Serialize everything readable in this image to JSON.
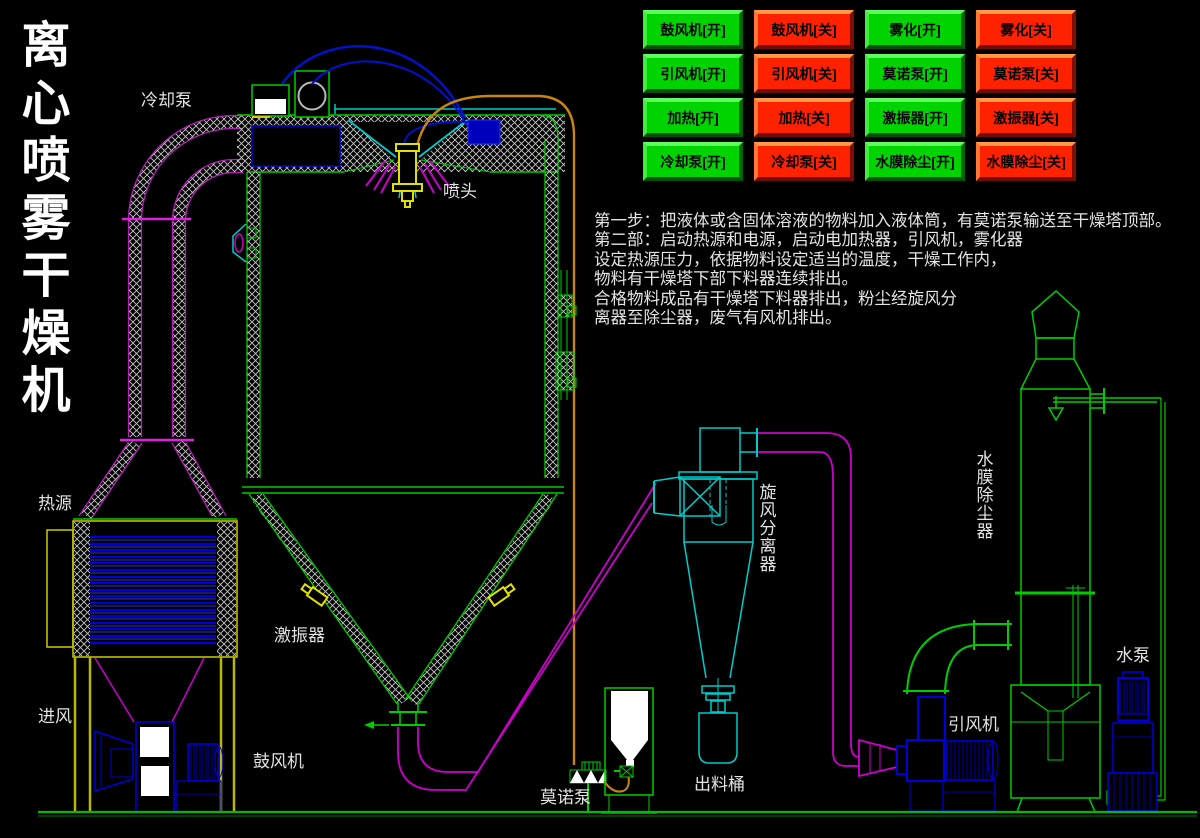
{
  "title": {
    "text": "离心喷雾干燥机"
  },
  "control_panel": {
    "buttons": [
      {
        "label": "鼓风机[开]",
        "state": "on"
      },
      {
        "label": "鼓风机[关]",
        "state": "off"
      },
      {
        "label": "雾化[开]",
        "state": "on"
      },
      {
        "label": "雾化[关]",
        "state": "off"
      },
      {
        "label": "引风机[开]",
        "state": "on"
      },
      {
        "label": "引风机[关]",
        "state": "off"
      },
      {
        "label": "莫诺泵[开]",
        "state": "on"
      },
      {
        "label": "莫诺泵[关]",
        "state": "off"
      },
      {
        "label": "加热[开]",
        "state": "on"
      },
      {
        "label": "加热[关]",
        "state": "off"
      },
      {
        "label": "激振器[开]",
        "state": "on"
      },
      {
        "label": "激振器[关]",
        "state": "off"
      },
      {
        "label": "冷却泵[开]",
        "state": "on"
      },
      {
        "label": "冷却泵[关]",
        "state": "off"
      },
      {
        "label": "水膜除尘[开]",
        "state": "on"
      },
      {
        "label": "水膜除尘[关]",
        "state": "off"
      }
    ]
  },
  "instructions": {
    "lines": [
      "第一步：把液体或含固体溶液的物料加入液体筒，有莫诺泵输送至干燥塔顶部。",
      "第二部：启动热源和电源，启动电加热器，引风机，雾化器",
      "设定热源压力，依据物料设定适当的温度，干燥工作内，",
      "物料有干燥塔下部下料器连续排出。",
      "合格物料成品有干燥塔下料器排出，粉尘经旋风分",
      "离器至除尘器，废气有风机排出。"
    ]
  },
  "diagram": {
    "labels": {
      "cooling_pump": "冷却泵",
      "spray_head": "喷头",
      "heat_source": "热源",
      "air_inlet": "进风",
      "blower": "鼓风机",
      "vibrator": "激振器",
      "mono_pump": "莫诺泵",
      "discharge_barrel": "出料桶",
      "cyclone": "旋风分离器",
      "draft_fan": "引风机",
      "scrubber": "水膜除尘器",
      "water_pump": "水泵"
    },
    "colors": {
      "button_on": "#00d400",
      "button_off": "#ff2200",
      "cad_green": "#00cc00",
      "cad_cyan": "#00cccc",
      "cad_magenta": "#cc00cc",
      "cad_yellow": "#cccc00",
      "cad_blue": "#0000dd",
      "cad_orange": "#c8860b",
      "background": "#000000"
    }
  }
}
